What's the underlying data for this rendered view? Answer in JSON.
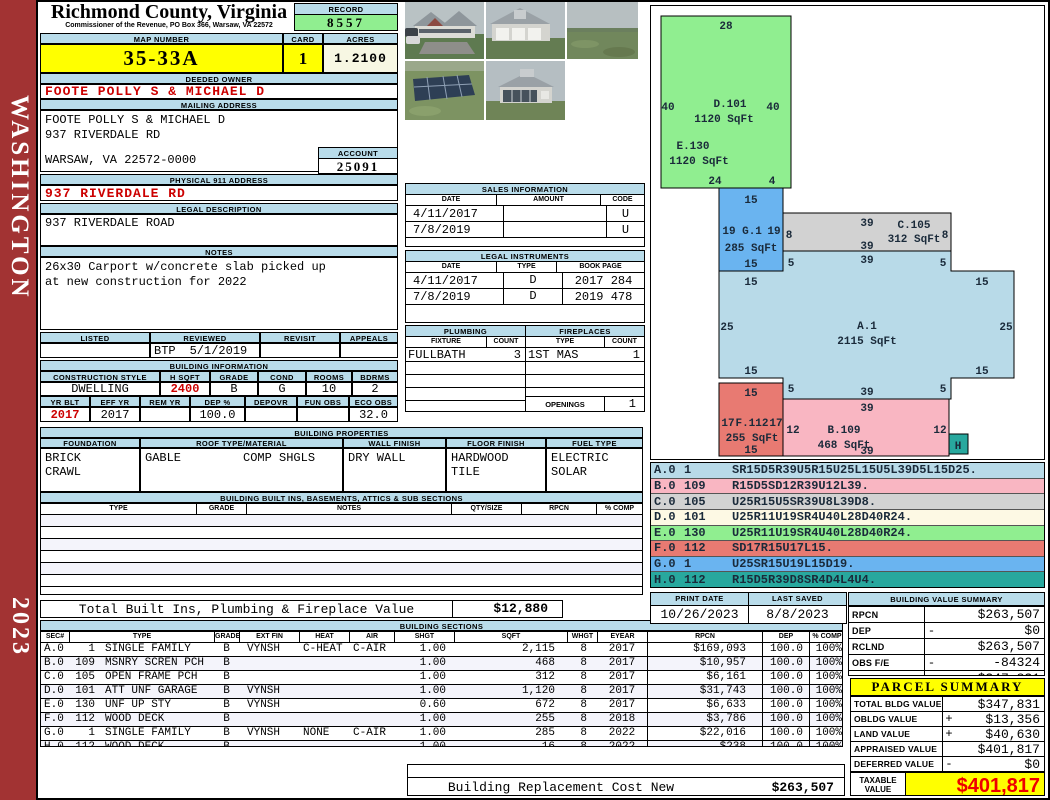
{
  "sidebar": {
    "county": "WASHINGTON",
    "year": "2023"
  },
  "title": {
    "county": "Richmond County, Virginia",
    "office": "Commissioner of the Revenue, PO Box 366, Warsaw, VA 22572"
  },
  "record": {
    "label": "RECORD",
    "value": "8557"
  },
  "map": {
    "label": "MAP NUMBER",
    "value": "35-33A"
  },
  "card": {
    "label": "CARD",
    "value": "1"
  },
  "acres": {
    "label": "ACRES",
    "value": "1.2100"
  },
  "owner": {
    "label": "DEEDED OWNER",
    "name": "FOOTE POLLY S & MICHAEL D"
  },
  "mailing": {
    "label": "MAILING ADDRESS",
    "line1": "FOOTE POLLY S & MICHAEL D",
    "line2": "937 RIVERDALE RD",
    "line3": "WARSAW, VA 22572-0000"
  },
  "account": {
    "label": "ACCOUNT",
    "value": "25091"
  },
  "physical": {
    "label": "PHYSICAL 911 ADDRESS",
    "value": "937 RIVERDALE RD"
  },
  "legal": {
    "label": "LEGAL DESCRIPTION",
    "value": "937 RIVERDALE ROAD"
  },
  "notes": {
    "label": "NOTES",
    "line1": "26x30 Carport w/concrete slab picked up",
    "line2": "at new construction for 2022"
  },
  "review": {
    "listed_label": "LISTED",
    "reviewed_label": "REVIEWED",
    "revisit_label": "REVISIT",
    "appeals_label": "APPEALS",
    "reviewer": "BTP",
    "date": "5/1/2019"
  },
  "binfo": {
    "label": "BUILDING INFORMATION",
    "style_label": "CONSTRUCTION STYLE",
    "style": "DWELLING",
    "hsqft_label": "H SQFT",
    "hsqft": "2400",
    "grade_label": "GRADE",
    "grade": "B",
    "cond_label": "COND",
    "cond": "G",
    "rooms_label": "ROOMS",
    "rooms": "10",
    "bdrms_label": "BDRMS",
    "bdrms": "2",
    "yrblt_label": "YR BLT",
    "yrblt": "2017",
    "effyr_label": "EFF YR",
    "effyr": "2017",
    "remyr_label": "REM YR",
    "remyr": "",
    "dep_label": "DEP %",
    "dep": "100.0",
    "depovr_label": "DEPOVR",
    "depovr": "",
    "funobs_label": "FUN OBS",
    "funobs": "",
    "ecoobs_label": "ECO OBS",
    "ecoobs": "32.0"
  },
  "props": {
    "label": "BUILDING PROPERTIES",
    "foundation_label": "FOUNDATION",
    "foundation1": "BRICK",
    "foundation2": "CRAWL",
    "roof_label": "ROOF TYPE/MATERIAL",
    "roof1": "GABLE",
    "roof2": "COMP SHGLS",
    "wall_label": "WALL FINISH",
    "wall": "DRY WALL",
    "floor_label": "FLOOR FINISH",
    "floor1": "HARDWOOD",
    "floor2": "TILE",
    "fuel_label": "FUEL TYPE",
    "fuel1": "ELECTRIC",
    "fuel2": "SOLAR"
  },
  "builtins": {
    "label": "BUILDING BUILT INS, BASEMENTS, ATTICS & SUB SECTIONS",
    "type_label": "TYPE",
    "grade_label": "GRADE",
    "notes_label": "NOTES",
    "qty_label": "QTY/SIZE",
    "rpcn_label": "RPCN",
    "comp_label": "% COMP",
    "total_label": "Total Built Ins, Plumbing & Fireplace Value",
    "total_value": "$12,880"
  },
  "sales": {
    "label": "SALES INFORMATION",
    "date_label": "DATE",
    "amount_label": "AMOUNT",
    "code_label": "CODE",
    "rows": [
      {
        "date": "4/11/2017",
        "amount": "",
        "code": "U"
      },
      {
        "date": "7/8/2019",
        "amount": "",
        "code": "U"
      }
    ]
  },
  "instruments": {
    "label": "LEGAL INSTRUMENTS",
    "date_label": "DATE",
    "type_label": "TYPE",
    "book_label": "BOOK PAGE",
    "rows": [
      {
        "date": "4/11/2017",
        "type": "D",
        "book": "2017 284"
      },
      {
        "date": "7/8/2019",
        "type": "D",
        "book": "2019 478"
      }
    ]
  },
  "plumbing": {
    "label": "PLUMBING",
    "fixture_label": "FIXTURE",
    "count_label": "COUNT",
    "fixture": "FULLBATH",
    "count": "3"
  },
  "fireplaces": {
    "label": "FIREPLACES",
    "type_label": "TYPE",
    "count_label": "COUNT",
    "type": "1ST MAS",
    "count": "1",
    "openings_label": "OPENINGS",
    "openings": "1"
  },
  "sections": {
    "label": "BUILDING SECTIONS",
    "cols": {
      "sec": "SEC#",
      "type": "TYPE",
      "grade": "GRADE",
      "ext": "EXT FIN",
      "heat": "HEAT",
      "air": "AIR",
      "shgt": "SHGT",
      "sqft": "SQFT",
      "whgt": "WHGT",
      "eyear": "EYEAR",
      "rpcn": "RPCN",
      "dep": "DEP",
      "comp": "% COMP"
    },
    "rows": [
      {
        "sec": "A.0",
        "code": "1",
        "type": "SINGLE FAMILY",
        "grade": "B",
        "ext": "VYNSH",
        "heat": "C-HEAT",
        "air": "C-AIR",
        "shgt": "1.00",
        "sqft": "2,115",
        "whgt": "8",
        "eyear": "2017",
        "rpcn": "$169,093",
        "dep": "100.0",
        "comp": "100%"
      },
      {
        "sec": "B.0",
        "code": "109",
        "type": "MSNRY SCREN PCH",
        "grade": "B",
        "ext": "",
        "heat": "",
        "air": "",
        "shgt": "1.00",
        "sqft": "468",
        "whgt": "8",
        "eyear": "2017",
        "rpcn": "$10,957",
        "dep": "100.0",
        "comp": "100%"
      },
      {
        "sec": "C.0",
        "code": "105",
        "type": "OPEN FRAME PCH",
        "grade": "B",
        "ext": "",
        "heat": "",
        "air": "",
        "shgt": "1.00",
        "sqft": "312",
        "whgt": "8",
        "eyear": "2017",
        "rpcn": "$6,161",
        "dep": "100.0",
        "comp": "100%"
      },
      {
        "sec": "D.0",
        "code": "101",
        "type": "ATT UNF GARAGE",
        "grade": "B",
        "ext": "VYNSH",
        "heat": "",
        "air": "",
        "shgt": "1.00",
        "sqft": "1,120",
        "whgt": "8",
        "eyear": "2017",
        "rpcn": "$31,743",
        "dep": "100.0",
        "comp": "100%"
      },
      {
        "sec": "E.0",
        "code": "130",
        "type": "UNF UP STY",
        "grade": "B",
        "ext": "VYNSH",
        "heat": "",
        "air": "",
        "shgt": "0.60",
        "sqft": "672",
        "whgt": "8",
        "eyear": "2017",
        "rpcn": "$6,633",
        "dep": "100.0",
        "comp": "100%"
      },
      {
        "sec": "F.0",
        "code": "112",
        "type": "WOOD DECK",
        "grade": "B",
        "ext": "",
        "heat": "",
        "air": "",
        "shgt": "1.00",
        "sqft": "255",
        "whgt": "8",
        "eyear": "2018",
        "rpcn": "$3,786",
        "dep": "100.0",
        "comp": "100%"
      },
      {
        "sec": "G.0",
        "code": "1",
        "type": "SINGLE FAMILY",
        "grade": "B",
        "ext": "VYNSH",
        "heat": "NONE",
        "air": "C-AIR",
        "shgt": "1.00",
        "sqft": "285",
        "whgt": "8",
        "eyear": "2022",
        "rpcn": "$22,016",
        "dep": "100.0",
        "comp": "100%"
      },
      {
        "sec": "H.0",
        "code": "112",
        "type": "WOOD DECK",
        "grade": "B",
        "ext": "",
        "heat": "",
        "air": "",
        "shgt": "1.00",
        "sqft": "16",
        "whgt": "8",
        "eyear": "2022",
        "rpcn": "$238",
        "dep": "100.0",
        "comp": "100%"
      }
    ]
  },
  "replacement": {
    "label": "Building Replacement Cost New",
    "value": "$263,507"
  },
  "printinfo": {
    "print_label": "PRINT DATE",
    "print_date": "10/26/2023",
    "saved_label": "LAST SAVED",
    "saved_date": "8/8/2023"
  },
  "bvs": {
    "label": "BUILDING VALUE SUMMARY",
    "rows": [
      {
        "k": "RPCN",
        "pct": "",
        "sign": "",
        "v": "$263,507"
      },
      {
        "k": "DEP",
        "pct": "",
        "sign": "-",
        "v": "$0"
      },
      {
        "k": "RCLND",
        "pct": "",
        "sign": "",
        "v": "$263,507"
      },
      {
        "k": "OBS F/E",
        "pct": "",
        "sign": "-",
        "v": "-84324"
      },
      {
        "k": "LCF",
        "pct": "100%",
        "sign": "",
        "v": "$347,831"
      }
    ]
  },
  "parcel": {
    "label": "PARCEL SUMMARY",
    "rows": [
      {
        "k": "TOTAL BLDG VALUE",
        "sign": "",
        "v": "$347,831"
      },
      {
        "k": "OBLDG VALUE",
        "sign": "+",
        "v": "$13,356"
      },
      {
        "k": "LAND VALUE",
        "sign": "+",
        "v": "$40,630"
      },
      {
        "k": "APPRAISED VALUE",
        "sign": "",
        "v": "$401,817"
      },
      {
        "k": "DEFERRED VALUE",
        "sign": "-",
        "v": "$0"
      }
    ],
    "taxable_label": "TAXABLE VALUE",
    "taxable_value": "$401,817"
  },
  "sketch": {
    "labels": [
      "28",
      "40",
      "D.101",
      "40",
      "1120 SqFt",
      "E.130",
      "1120 SqFt",
      "24",
      "4",
      "15",
      "19",
      "G.1",
      "19",
      "285 SqFt",
      "15",
      "39",
      "C.105",
      "8",
      "312 SqFt",
      "8",
      "39",
      "39",
      "5",
      "5",
      "15",
      "15",
      "25",
      "A.1",
      "2115 SqFt",
      "25",
      "15",
      "15",
      "5",
      "39",
      "5",
      "15",
      "17",
      "F.112",
      "17",
      "255 SqFt",
      "15",
      "39",
      "12",
      "B.109",
      "12",
      "468 SqFt",
      "39",
      "H"
    ],
    "legend": [
      {
        "id": "A.0",
        "num": "1",
        "path": "SR15D5R39U5R15U25L15U5L39D5L15D25."
      },
      {
        "id": "B.0",
        "num": "109",
        "path": "R15D5SD12R39U12L39."
      },
      {
        "id": "C.0",
        "num": "105",
        "path": "U25R15U5SR39U8L39D8."
      },
      {
        "id": "D.0",
        "num": "101",
        "path": "U25R11U19SR4U40L28D40R24."
      },
      {
        "id": "E.0",
        "num": "130",
        "path": "U25R11U19SR4U40L28D40R24."
      },
      {
        "id": "F.0",
        "num": "112",
        "path": "SD17R15U17L15."
      },
      {
        "id": "G.0",
        "num": "1",
        "path": "U25SR15U19L15D19."
      },
      {
        "id": "H.0",
        "num": "112",
        "path": "R15D5R39D8SR4D4L4U4."
      }
    ]
  },
  "colors": {
    "header_bar": "#b9dcea",
    "highlight_yellow": "#ffff00",
    "record_green": "#90ee90",
    "alert_red": "#cc0000",
    "sidebar_red": "#a23333",
    "section_a": "#b8dae8",
    "section_b": "#f9b6c2",
    "section_c": "#d2d2d2",
    "section_d": "#fdf9e4",
    "section_e": "#90ee90",
    "section_f": "#e87a72",
    "section_g": "#6ab4f0",
    "section_h": "#28a89e"
  }
}
